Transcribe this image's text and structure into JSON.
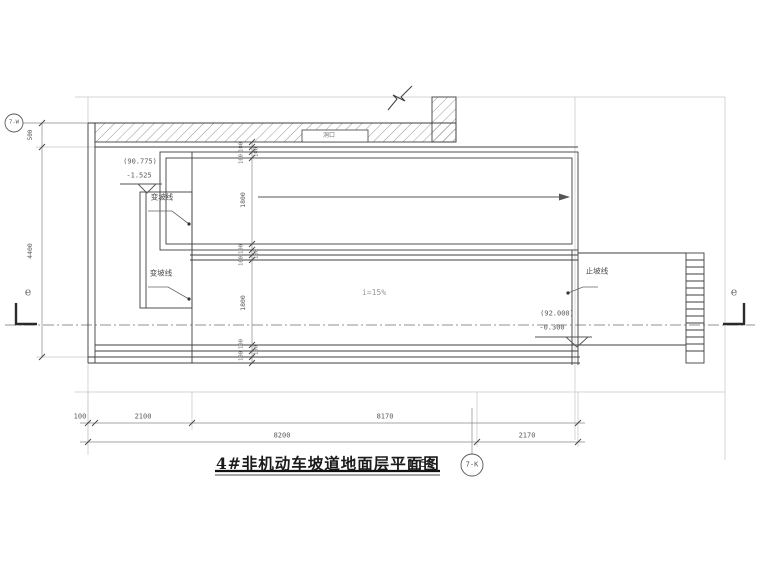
{
  "drawing": {
    "title": "4#非机动车坡道地面层平面图",
    "scale": "1:50"
  },
  "grid_bubbles": {
    "top_left": "7-W",
    "bottom": "7-K"
  },
  "section_markers": {
    "left_label": "e",
    "right_label": "e"
  },
  "elevations": {
    "upper": {
      "absolute": "(90.775)",
      "relative": "-1.525"
    },
    "lower": {
      "absolute": "(92.000)",
      "relative": "-0.300"
    }
  },
  "labels": {
    "slope_change_1": "变坡线",
    "slope_change_2": "变坡线",
    "slope_stop": "止坡线",
    "slope_value": "i=15%",
    "opening": "洞口"
  },
  "dims": {
    "v500": "500",
    "v4400": "4400",
    "lane_upper": "1800",
    "lane_lower": "1800",
    "chain_top": [
      "100",
      "100",
      "100"
    ],
    "chain_mid": [
      "100",
      "100",
      "100"
    ],
    "chain_bot": [
      "100",
      "100",
      "100"
    ],
    "row1": [
      "100",
      "2100",
      "8170"
    ],
    "row2": [
      "8200",
      "2170"
    ]
  }
}
